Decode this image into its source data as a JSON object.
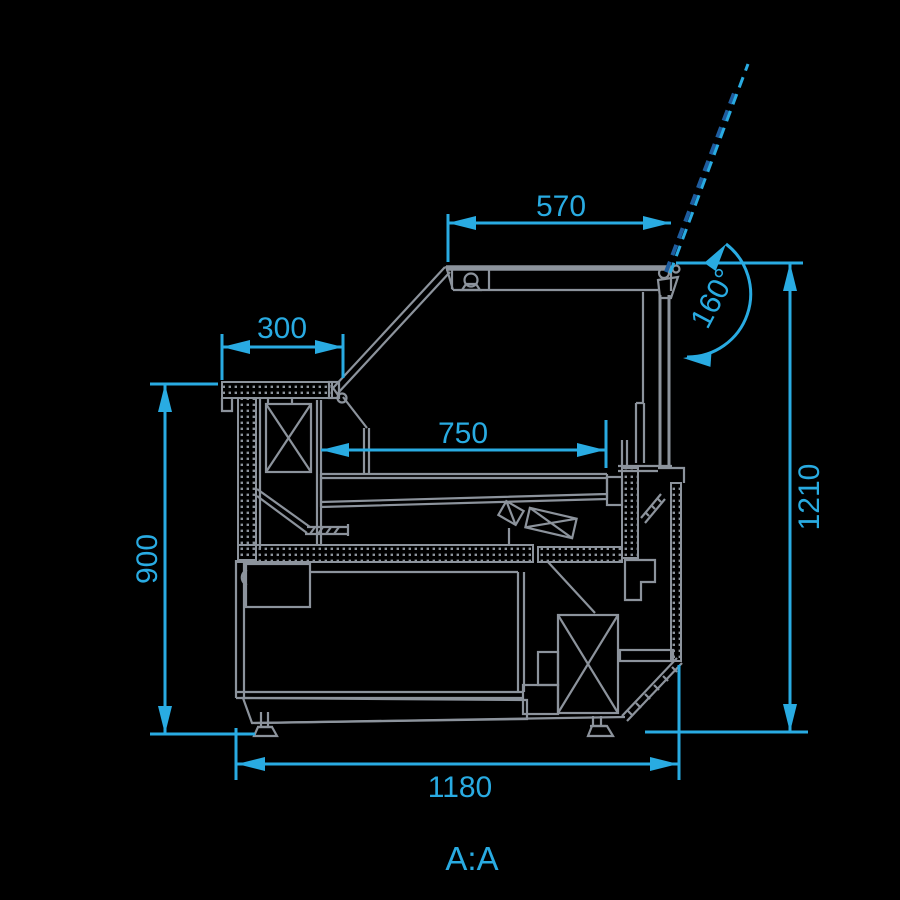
{
  "title": "Refrigerated serve-over display counter - cross section A:A",
  "section_label": "A:A",
  "colors": {
    "background": "#000000",
    "line": "#8C939C",
    "dimension": "#29ABE2",
    "lid_dash": "#1E5C9E"
  },
  "dimensions": {
    "top_width": "570",
    "counter_depth": "300",
    "display_depth": "750",
    "counter_height": "900",
    "total_height": "1210",
    "total_depth": "1180",
    "lid_opening_angle": "160°"
  }
}
